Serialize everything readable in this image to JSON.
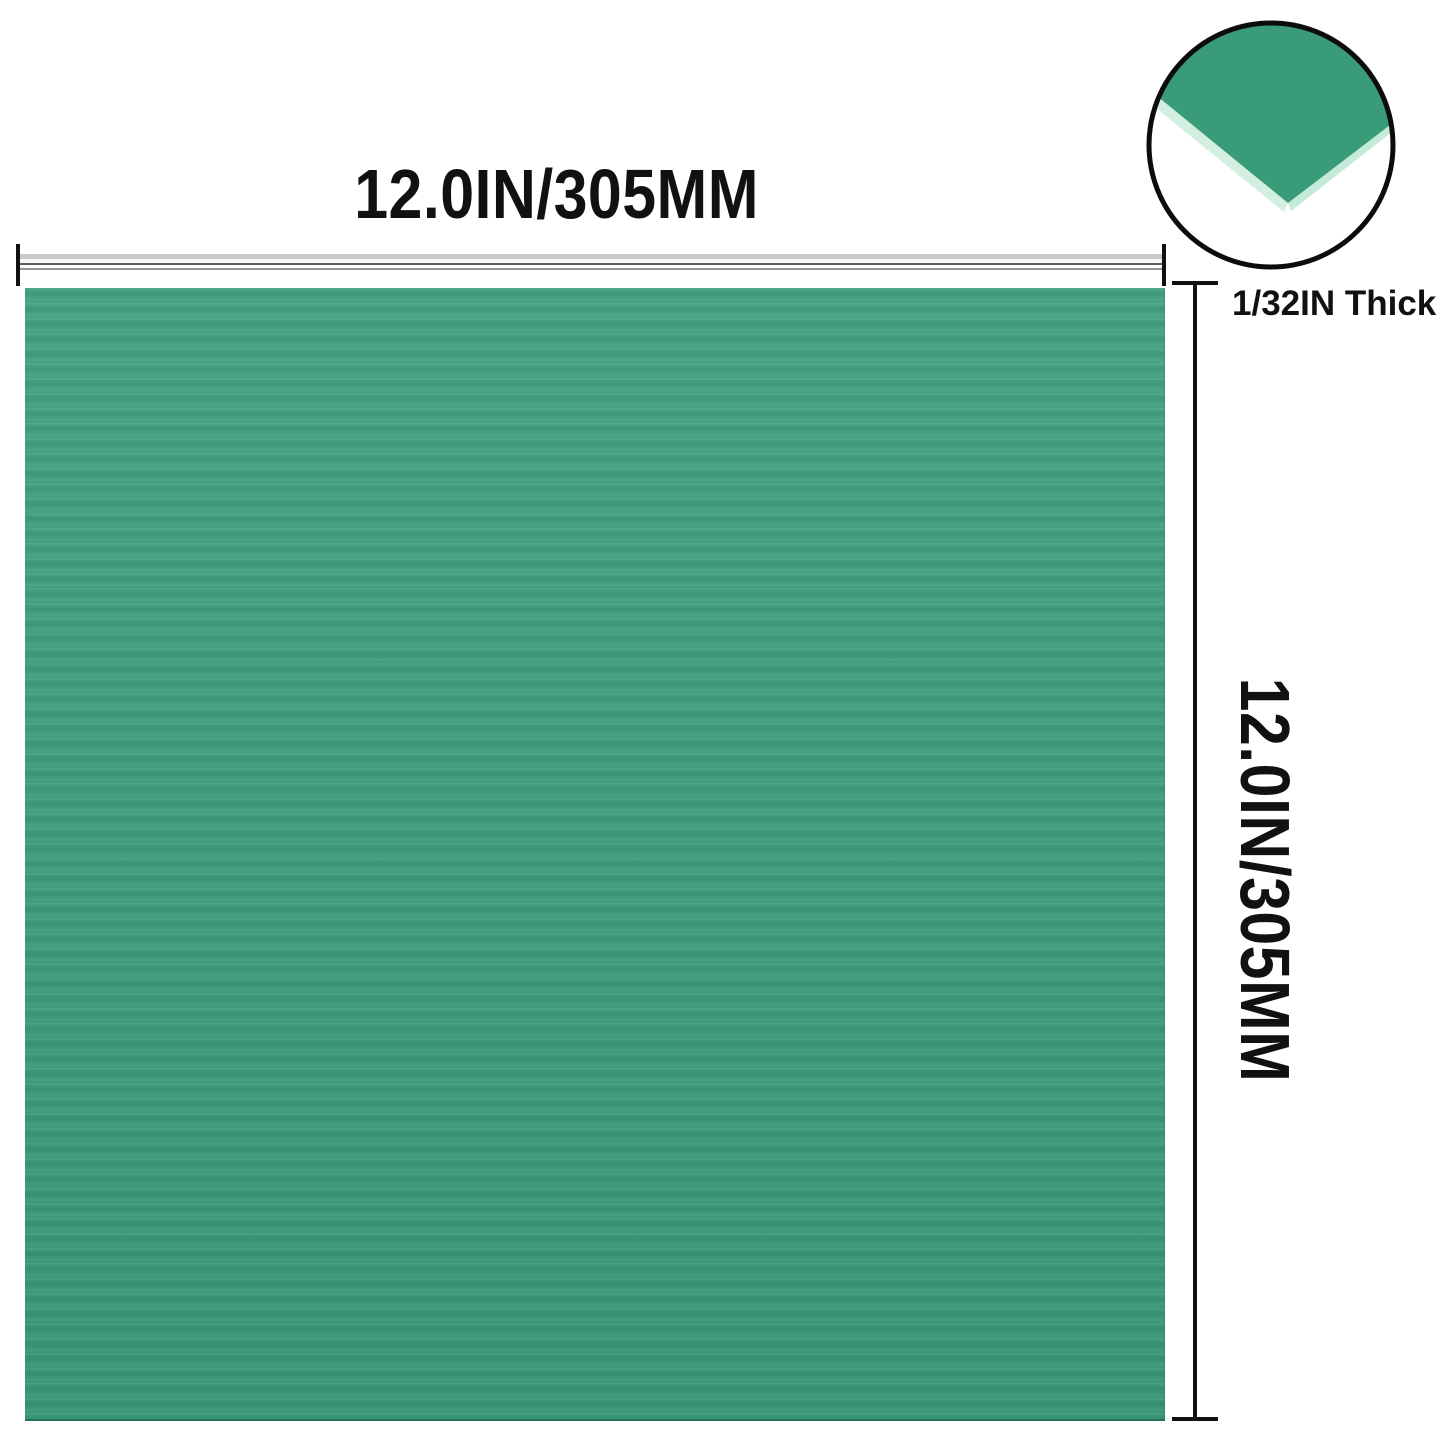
{
  "dimensions": {
    "width_label": "12.0IN/305MM",
    "height_label": "12.0IN/305MM",
    "thickness_label": "1/32IN Thick"
  },
  "inset": {
    "description": "sheet-corner-thickness-detail"
  },
  "colors": {
    "sheet_green": "#3a9b78",
    "sheet_edge_light": "#d3efe2",
    "sheet_edge_right": "#c4ead9",
    "dimension_ink": "#111111",
    "background": "#ffffff"
  }
}
